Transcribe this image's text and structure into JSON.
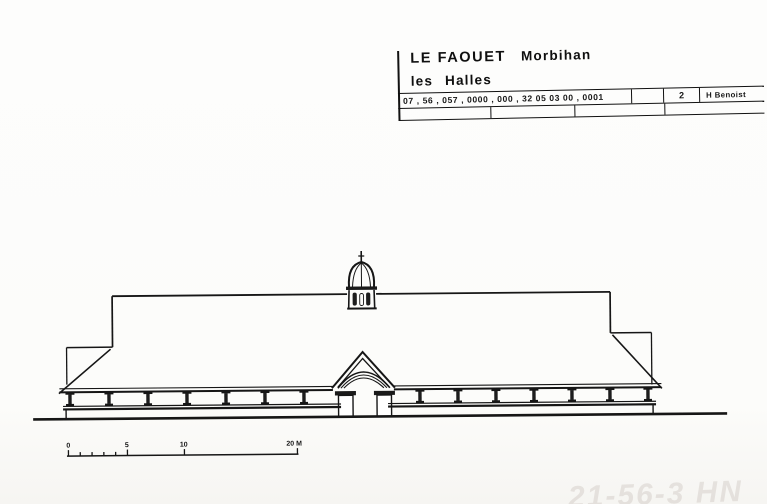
{
  "page": {
    "background": "#fcfcfb",
    "ink": "#161616"
  },
  "title_block": {
    "commune": "LE FAOUET",
    "department": "Morbihan",
    "subject": "les Halles",
    "reference_codes": "07 , 56 , 057 , 0000 , 000 , 32 05 03 00 , 0001",
    "sheet_number": "2",
    "author": "H Benoist"
  },
  "scale_bar": {
    "labels": [
      "0",
      "5",
      "10",
      "20 M"
    ],
    "unit": "M"
  },
  "watermark": "21-56-3 HN"
}
